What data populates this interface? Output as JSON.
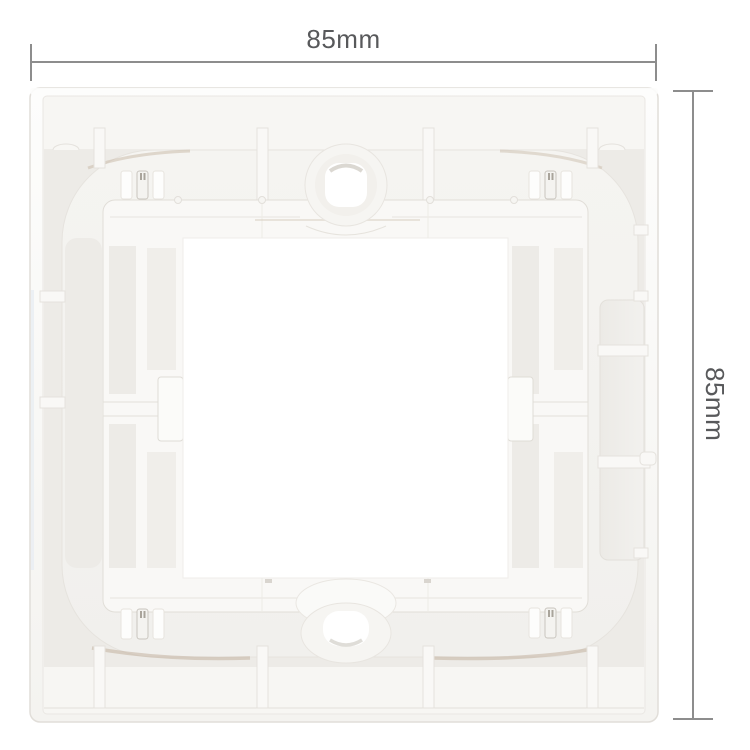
{
  "page": {
    "background": "#ffffff"
  },
  "dimension_annotations": {
    "width": {
      "label": "85mm"
    },
    "height": {
      "label": "85mm"
    },
    "line_color": "#8d8d8d",
    "label_color": "#58595b"
  },
  "product": {
    "subject": "white plastic wall-plate mounting frame, back view",
    "body_color": "#f7f6f3",
    "ring_color": "#f3f2ef",
    "recess_color": "#edebe7",
    "opening_color": "#ffffff",
    "shadow_tan": "#c8b8a6",
    "edge_line_color": "#e2dfda"
  }
}
